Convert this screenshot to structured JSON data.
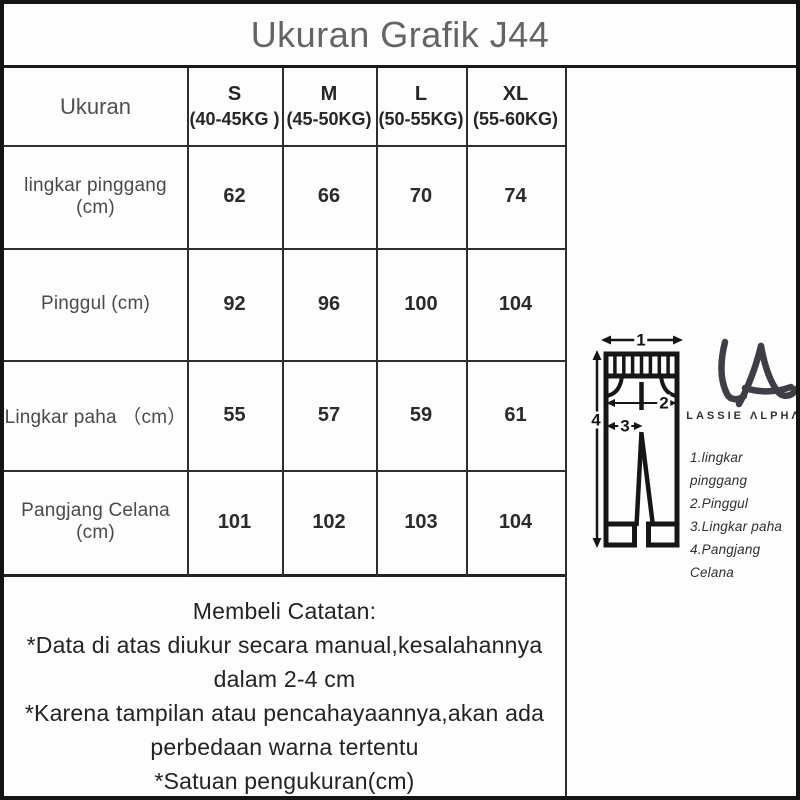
{
  "title": "Ukuran Grafik J44",
  "table": {
    "corner_label": "Ukuran",
    "columns": [
      {
        "size": "S",
        "weight": "(40-45KG )"
      },
      {
        "size": "M",
        "weight": "(45-50KG)"
      },
      {
        "size": "L",
        "weight": "(50-55KG)"
      },
      {
        "size": "XL",
        "weight": "(55-60KG)"
      }
    ],
    "rows": [
      {
        "label": "lingkar pinggang (cm)",
        "values": [
          "62",
          "66",
          "70",
          "74"
        ]
      },
      {
        "label": "Pinggul (cm)",
        "values": [
          "92",
          "96",
          "100",
          "104"
        ]
      },
      {
        "label": "Lingkar paha （cm）",
        "values": [
          "55",
          "57",
          "59",
          "61"
        ]
      },
      {
        "label": "Pangjang Celana (cm)",
        "values": [
          "101",
          "102",
          "103",
          "104"
        ]
      }
    ]
  },
  "notes": {
    "heading": "Membeli Catatan:",
    "lines": [
      "*Data di atas diukur secara manual,kesalahannya",
      "dalam 2-4 cm",
      "*Karena tampilan atau pencahayaannya,akan ada",
      "perbedaan warna tertentu",
      "*Satuan pengukuran(cm)"
    ]
  },
  "diagram": {
    "arrow_labels": {
      "waist": "1",
      "hip": "2",
      "thigh": "3",
      "length": "4"
    },
    "legend": [
      "1.lingkar pinggang",
      "2.Pinggul",
      "3.Lingkar paha",
      "4.Pangjang Celana"
    ]
  },
  "brand": {
    "name": "LASSIE ΛLPHΛ"
  },
  "colors": {
    "line": "#2e2e2e",
    "ink": "#161616",
    "logo": "#3e3e47",
    "title_gray": "#646464"
  }
}
